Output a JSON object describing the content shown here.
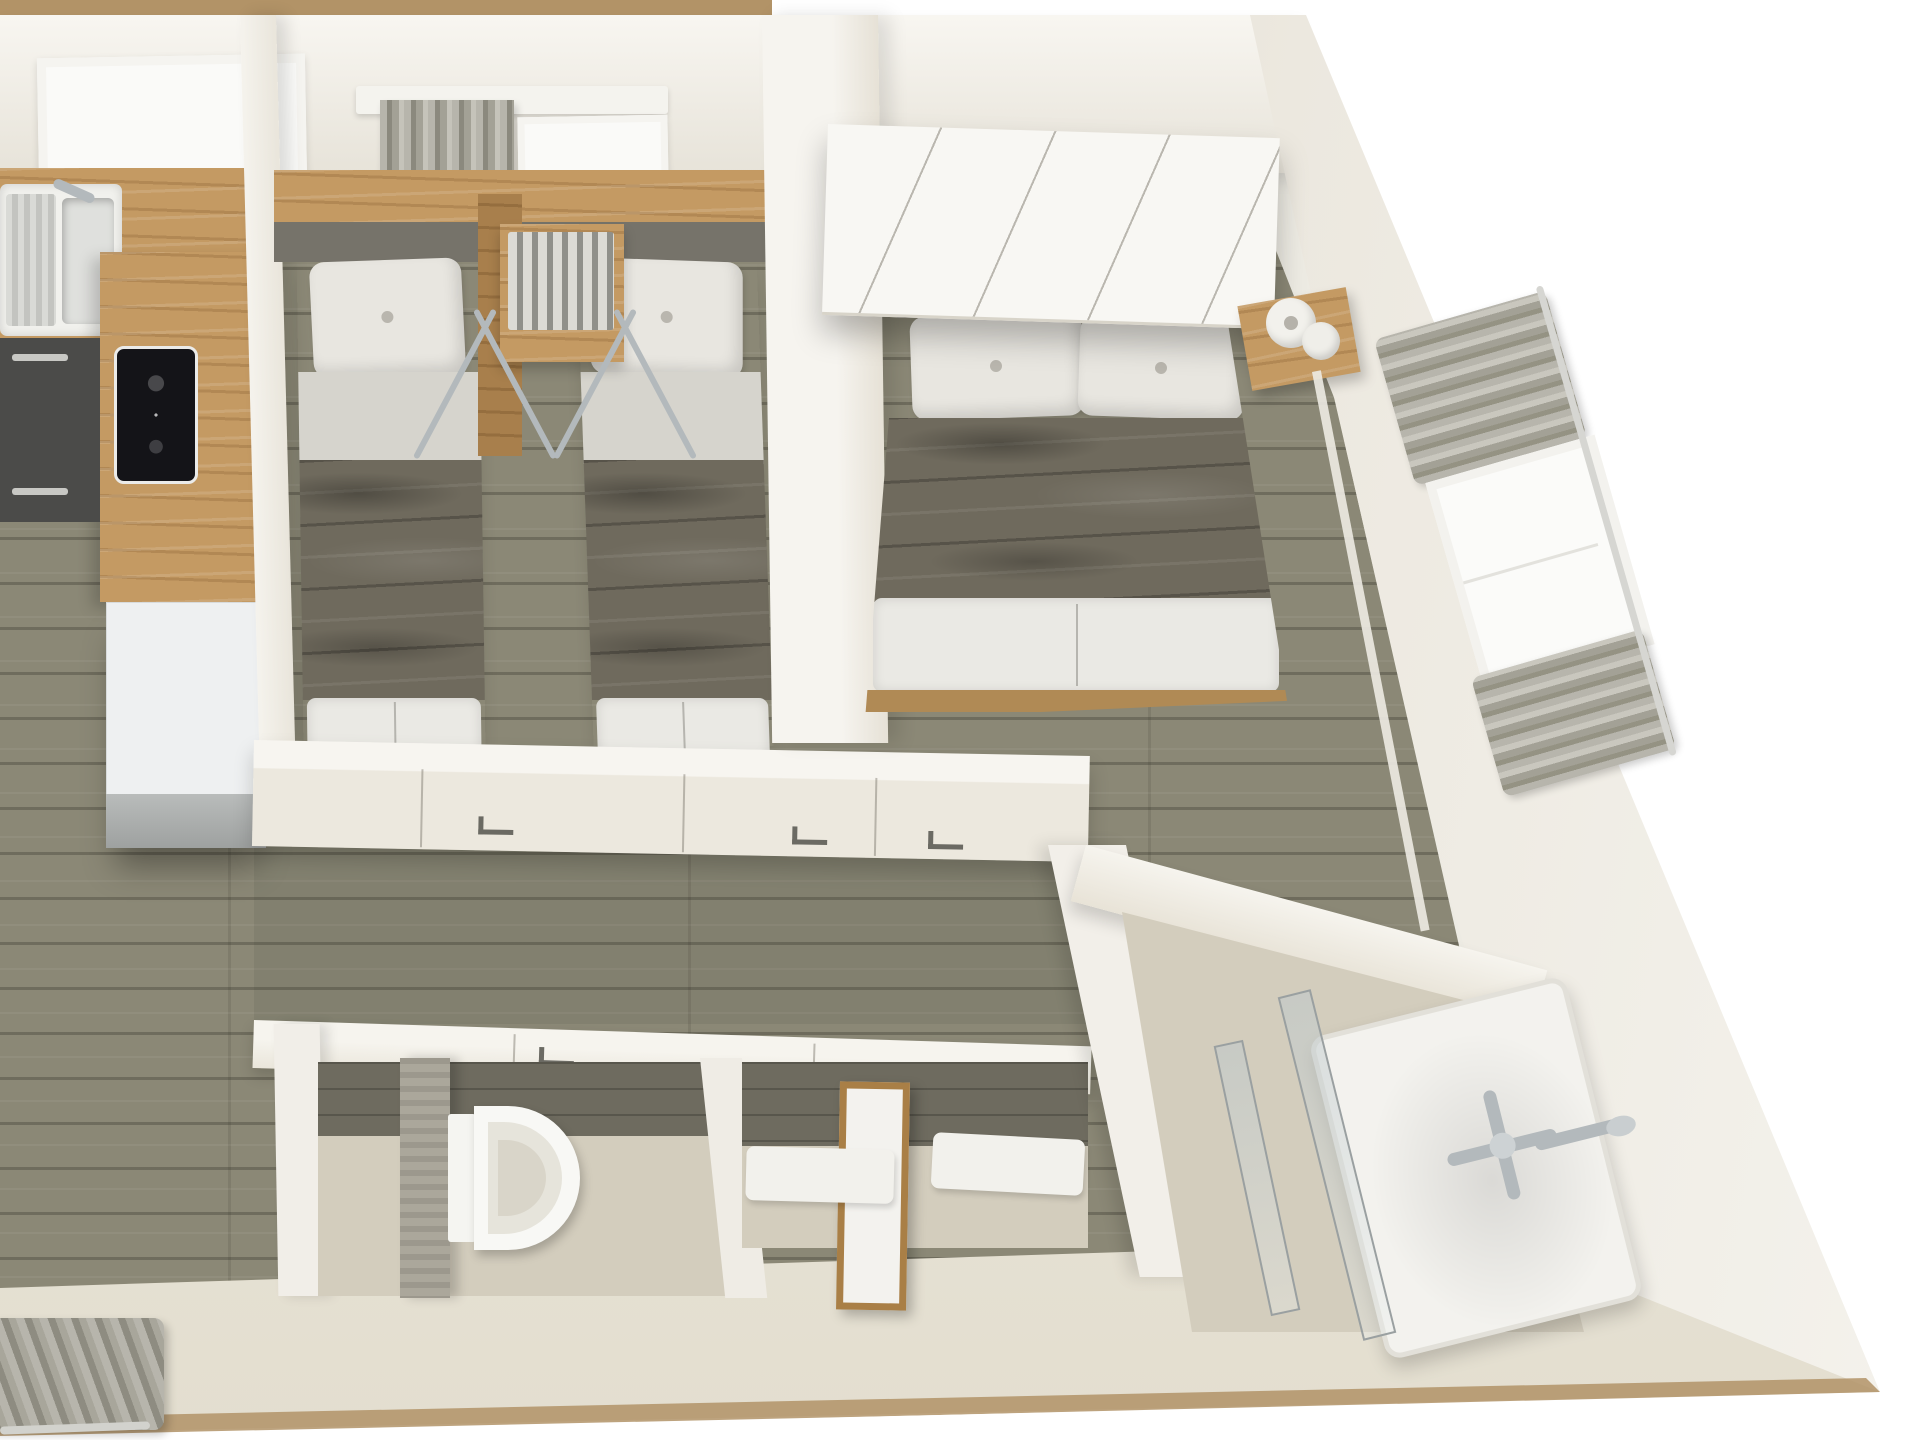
{
  "title": "Mobile home – 3D top-down floor plan render",
  "scene": {
    "type": "3d-floor-plan",
    "view": "top-down dollhouse cutaway, photorealistic render, no text",
    "background": "white",
    "skew": "building edges slant down-right (perspective)"
  },
  "colors": {
    "wall": "#edebe3",
    "wall-top": "#f8f6f1",
    "wall-shade": "#e7e3d9",
    "beige-face": "#d8d1c2",
    "trim-tan": "#b29367",
    "floor": "#8b8876",
    "wood": "#c49a63",
    "wood-dark": "#a87f4c",
    "cabinet-dark": "#4b4b49",
    "fridge": "#eef0f1",
    "hob": "#141418",
    "duvet": "#6f6a5d",
    "linen": "#d6d4cd",
    "soft-white": "#f4f3ee",
    "curtain": "#a3a196",
    "headboard": "#76736a",
    "stone": "#aba79b",
    "tile": "#6e6b5f",
    "bath-floor": "#d3cdbd",
    "chrome": "#b3b9bc"
  },
  "rooms": {
    "kitchen_living": {
      "label": "Open-plan kitchen and living area",
      "items": {
        "window": "Kitchen window",
        "sink": "Stainless sink with drainer and tap",
        "worktop": "Timber worktop and peninsula",
        "hob": "Black induction hob",
        "cabinets": "Dark base cabinets",
        "fridge": "White fridge",
        "curtain": "Grey curtain at living-room window",
        "floor": "Grey-olive wood plank floor"
      }
    },
    "twin_bedroom": {
      "label": "Twin bedroom",
      "items": {
        "curtain": "Grey pleated curtain",
        "window": "Small window",
        "headboard": "Timber headboard panel with grey pad",
        "bed_left": "Single bed with brown duvet",
        "bed_right": "Single bed with brown duvet",
        "rack": "Bedside unit with folding drying rack",
        "doors": "Sliding doors to hallway"
      }
    },
    "master_bedroom": {
      "label": "Master bedroom",
      "items": {
        "cabinet": "Overhead wardrobe cabinets above bed",
        "bed": "Double bed with brown duvet and white pillows",
        "nightstand": "Timber bedside shelf with rolled white towels",
        "window": "Side window with grey pleated curtains",
        "door": "Sliding door to hallway"
      }
    },
    "hallway": {
      "label": "Hallway",
      "items": {
        "doors": "Sliding pocket doors with recessed handles",
        "floor": "Wood plank floor"
      }
    },
    "wc": {
      "label": "WC",
      "items": {
        "toilet": "White toilet",
        "partition": "Stone privacy partition",
        "door": "Sliding door from hallway"
      }
    },
    "vestibule": {
      "label": "Shower vestibule",
      "items": {
        "mirror": "Timber-framed mirror",
        "mat_left": "White bath mat",
        "mat_right": "White bath mat",
        "glass": "Glass screen to shower room"
      }
    },
    "shower_room": {
      "label": "Shower room",
      "items": {
        "tray": "Walk-in shower tray",
        "screen": "Glass shower screen",
        "mixer": "Chrome shower mixer",
        "rail": "Chrome shower rail with hand shower"
      }
    }
  }
}
